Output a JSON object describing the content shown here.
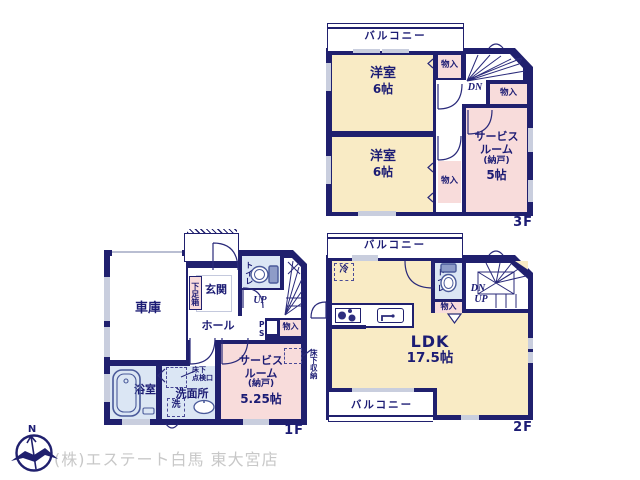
{
  "common": {
    "closet": "物入",
    "balcony": "バルコニー",
    "toilet": "トイレ",
    "dn": "DN",
    "up": "UP",
    "service1": "サービス",
    "service2": "ルーム",
    "service3": "(納戸)"
  },
  "f3": {
    "label": "3F",
    "west": "洋室",
    "west_size": "6帖",
    "service_size": "5帖"
  },
  "f2": {
    "label": "2F",
    "ldk": "LDK",
    "ldk_size": "17.5帖",
    "fridge": "冷"
  },
  "f1": {
    "label": "1F",
    "garage": "車庫",
    "entrance": "玄関",
    "shoebox": "下足箱",
    "hall": "ホール",
    "ps": "PS",
    "service_size": "5.25帖",
    "floor_storage": "床下収納",
    "inspect1": "床下",
    "inspect2": "点検口",
    "washroom": "洗面所",
    "washer": "洗",
    "bath": "浴室"
  },
  "footer": {
    "company": "(株)エステート白馬 東大宮店",
    "north": "N"
  },
  "colors": {
    "wall": "#20206e",
    "room_cream": "#f9ebc5",
    "room_pink": "#f8dcdb",
    "room_blue": "#dbe6f4",
    "window": "#c9cede",
    "text": "#1c1c74",
    "watermark": "#c8c8c8"
  }
}
